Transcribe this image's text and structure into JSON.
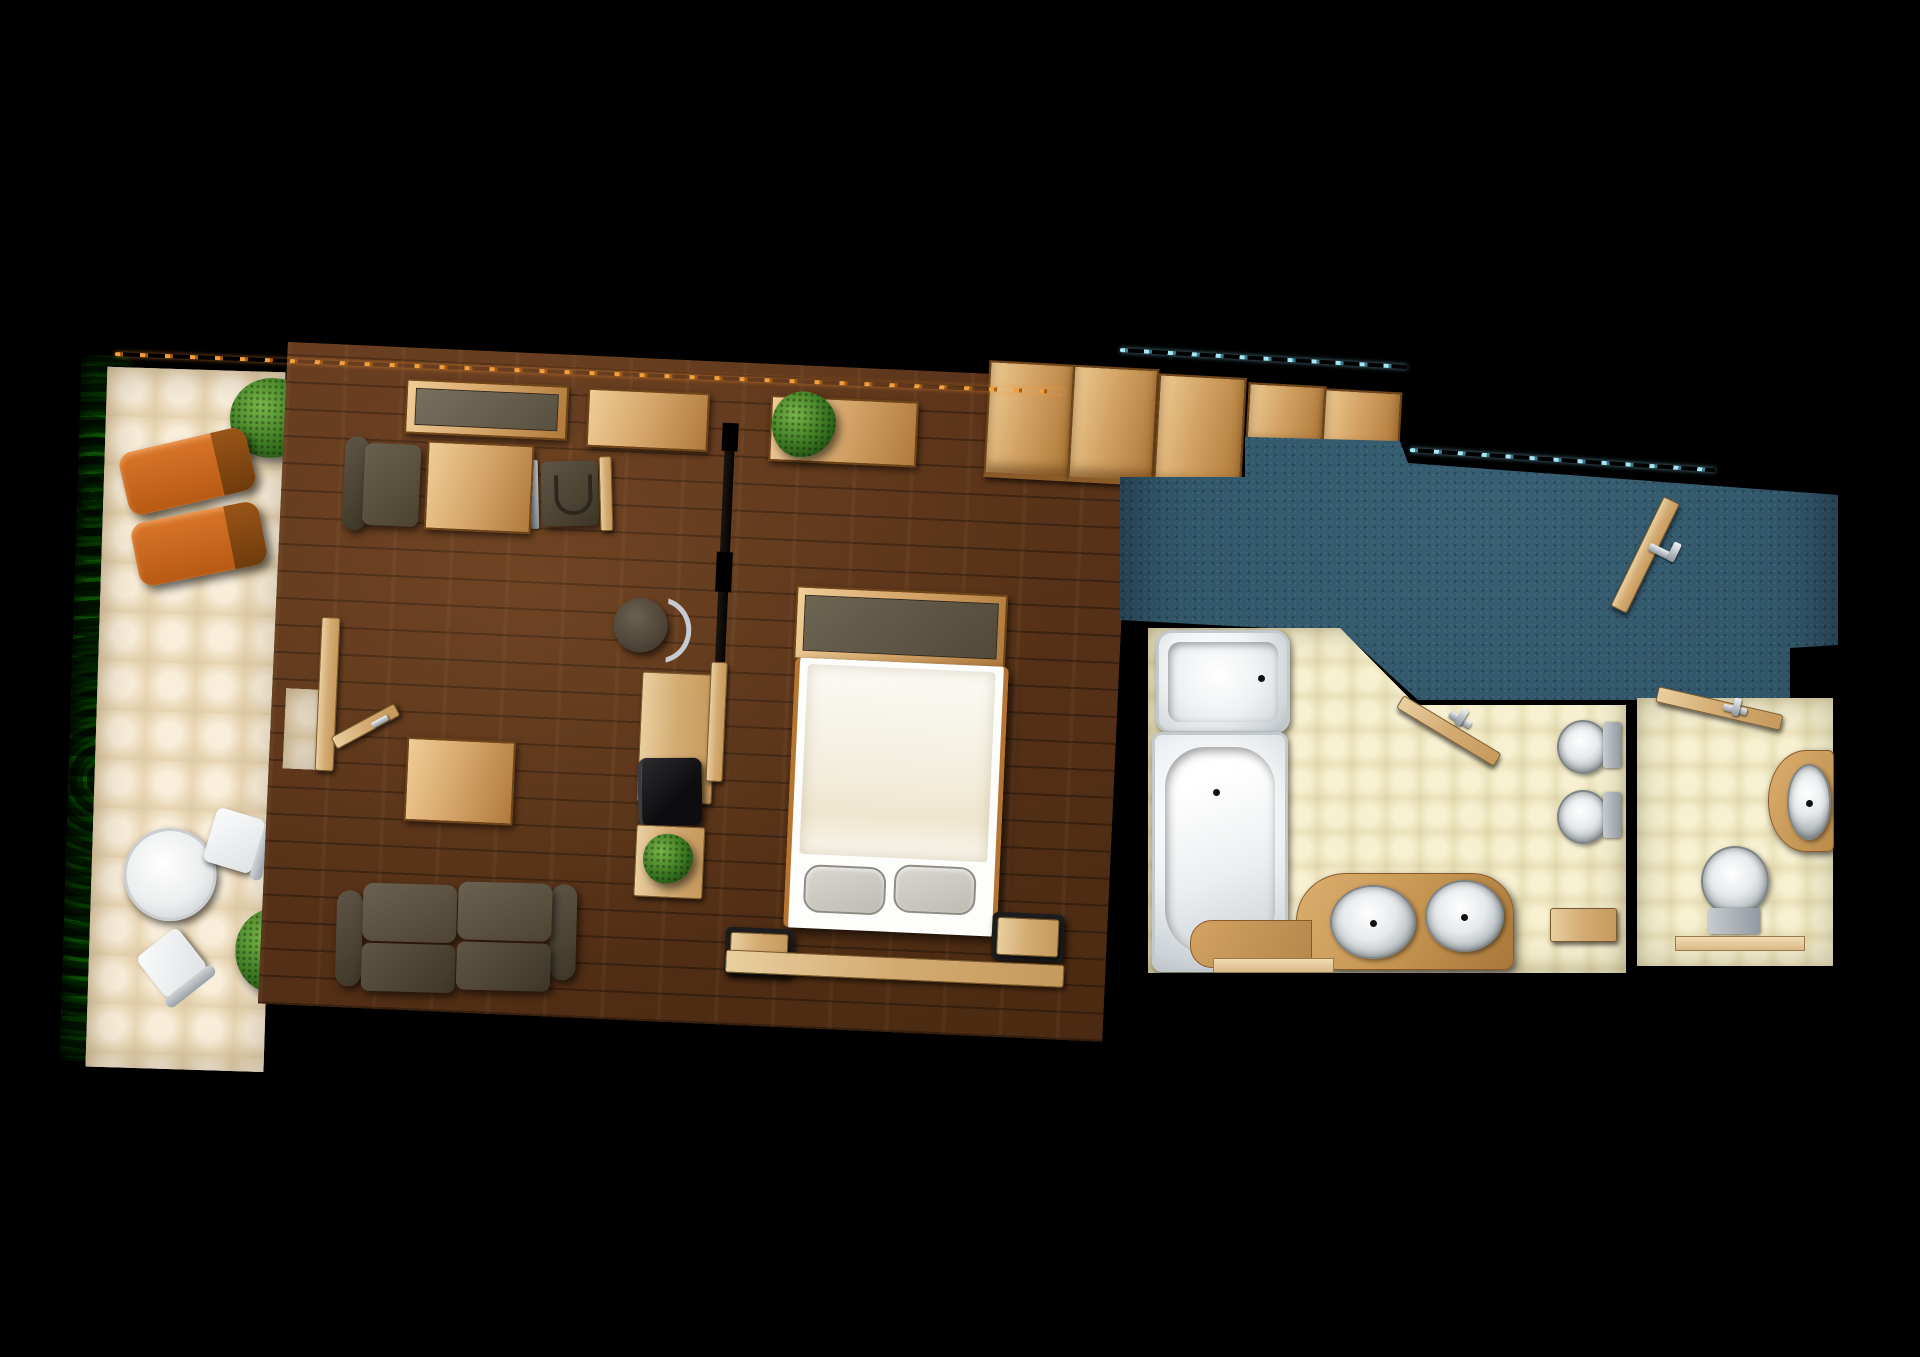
{
  "app": {
    "title": "Hotel suite floor plan - top-down 3D render"
  },
  "colors": {
    "background": "#000000",
    "terrace_tile": "#ead9bd",
    "wood_floor": "#58331a",
    "hall_carpet": "#31566a",
    "bath_tile": "#efe8c6",
    "lounger_orange": "#c2651c",
    "light_wood": "#d3a263",
    "dark_upholstery": "#4e4539",
    "led_strip_orange": "#e08a28",
    "led_strip_cyan": "#8fd6e8"
  },
  "rooms": {
    "terrace": {
      "label": "Terrace / balcony",
      "items": [
        "hedge",
        "shrub",
        "sun lounger",
        "sun lounger",
        "bistro table",
        "terrace chair",
        "terrace chair",
        "shrub"
      ]
    },
    "living_room": {
      "label": "Living room",
      "items": [
        "sideboard",
        "desk",
        "desk chair",
        "armchair",
        "coffee table",
        "coffee table",
        "sofa",
        "stool",
        "tv console",
        "plant shelf",
        "terrace door"
      ]
    },
    "bedroom": {
      "label": "Bedroom",
      "items": [
        "window planter",
        "wardrobe",
        "double bed",
        "foot bench",
        "pillow",
        "pillow",
        "nightstand",
        "nightstand"
      ]
    },
    "hallway": {
      "label": "Entrance hall",
      "items": [
        "hall wardrobe",
        "entry door"
      ]
    },
    "bathroom": {
      "label": "Main bathroom",
      "items": [
        "shower",
        "bathtub",
        "double vanity",
        "sink",
        "sink",
        "toilet",
        "bidet",
        "bathroom door",
        "shelf"
      ]
    },
    "wc": {
      "label": "Second bathroom",
      "items": [
        "door",
        "corner vanity",
        "sink",
        "toilet"
      ]
    }
  }
}
